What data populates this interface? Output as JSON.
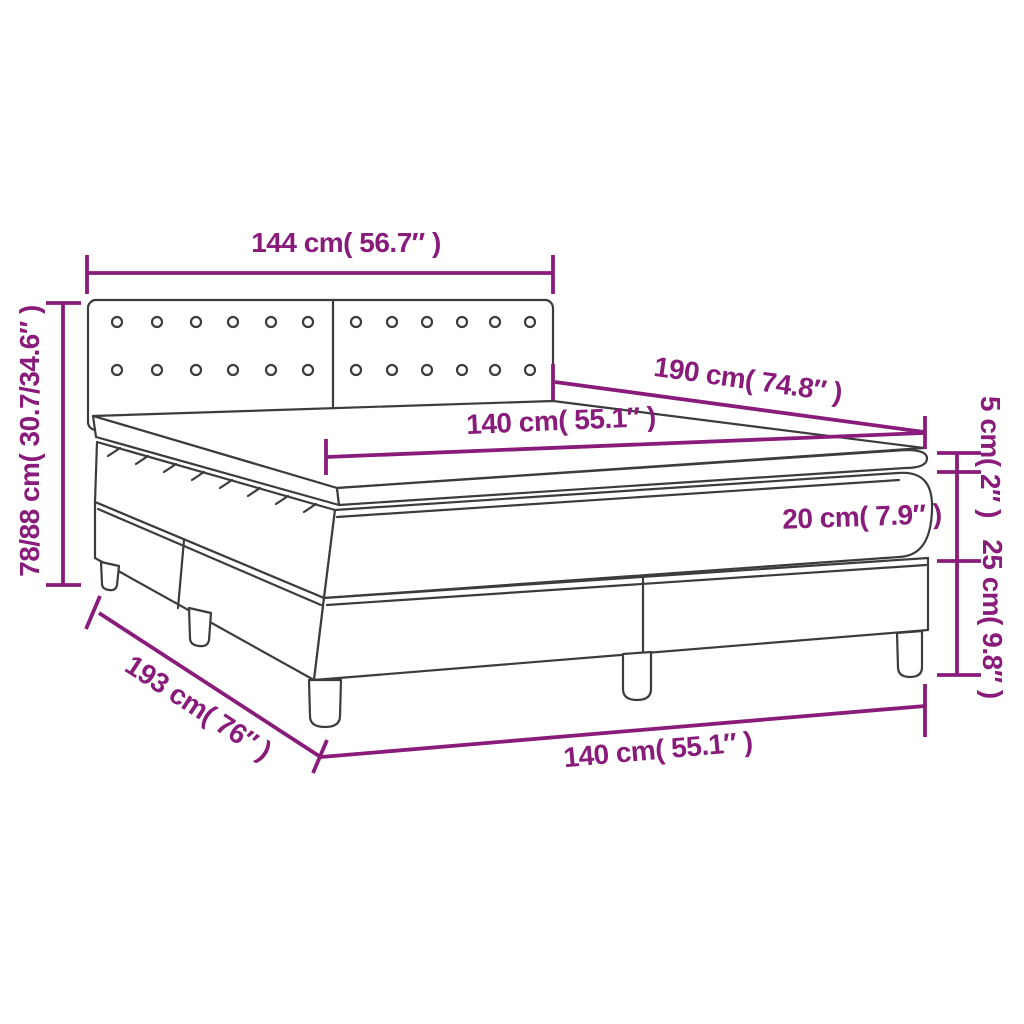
{
  "diagram": {
    "subject": "box spring bed with mattress and topper – dimension drawing",
    "colors": {
      "dimension_accent": "#891C7B",
      "outline": "#3C3C3C",
      "background": "#FFFFFF"
    },
    "labels": {
      "headboard_width": "144 cm( 56.7″ )",
      "overall_height": "78/88 cm( 30.7/34.6″ )",
      "mattress_length": "190 cm( 74.8″ )",
      "mattress_width": "140 cm( 55.1″ )",
      "topper_thickness": "5 cm( 2″ )",
      "mattress_thickness": "20 cm( 7.9″ )",
      "base_height": "25 cm( 9.8″ )",
      "base_length": "193 cm( 76″ )",
      "base_width": "140 cm( 55.1″ )"
    }
  }
}
